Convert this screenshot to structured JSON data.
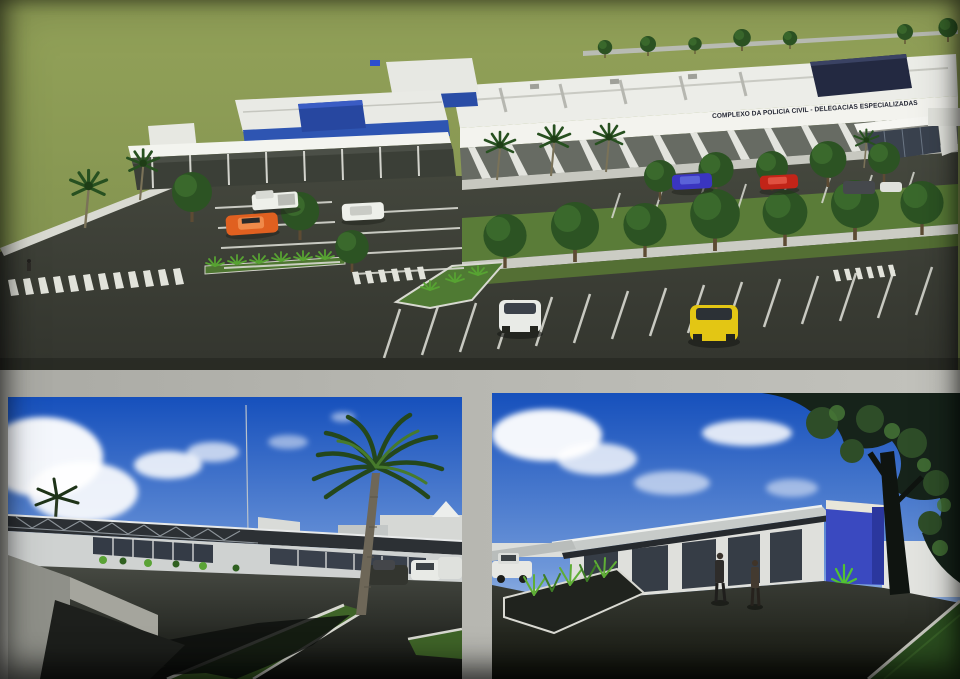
{
  "building_sign": "COMPLEXO DA POLICIA CIVIL - DELEGACIAS ESPECIALIZADAS",
  "palette": {
    "field_green": "#8a9a55",
    "grass_median": "#597b37",
    "asphalt": "#3c3f39",
    "building_white": "#ededea",
    "accent_blue": "#2e55b2",
    "navy_roof": "#232941",
    "entrance_blue": "#3a49c0",
    "sky_top": "#1650bc",
    "sky_horizon": "#90b1e1",
    "tree_green": "#2c5323",
    "plant_bright": "#57a332",
    "page_grey": "#b5b5af",
    "car_orange": "#e06020",
    "car_yellow": "#e3c614",
    "car_red": "#c22418",
    "car_blue": "#3a35c0",
    "car_white": "#eef0ea"
  }
}
